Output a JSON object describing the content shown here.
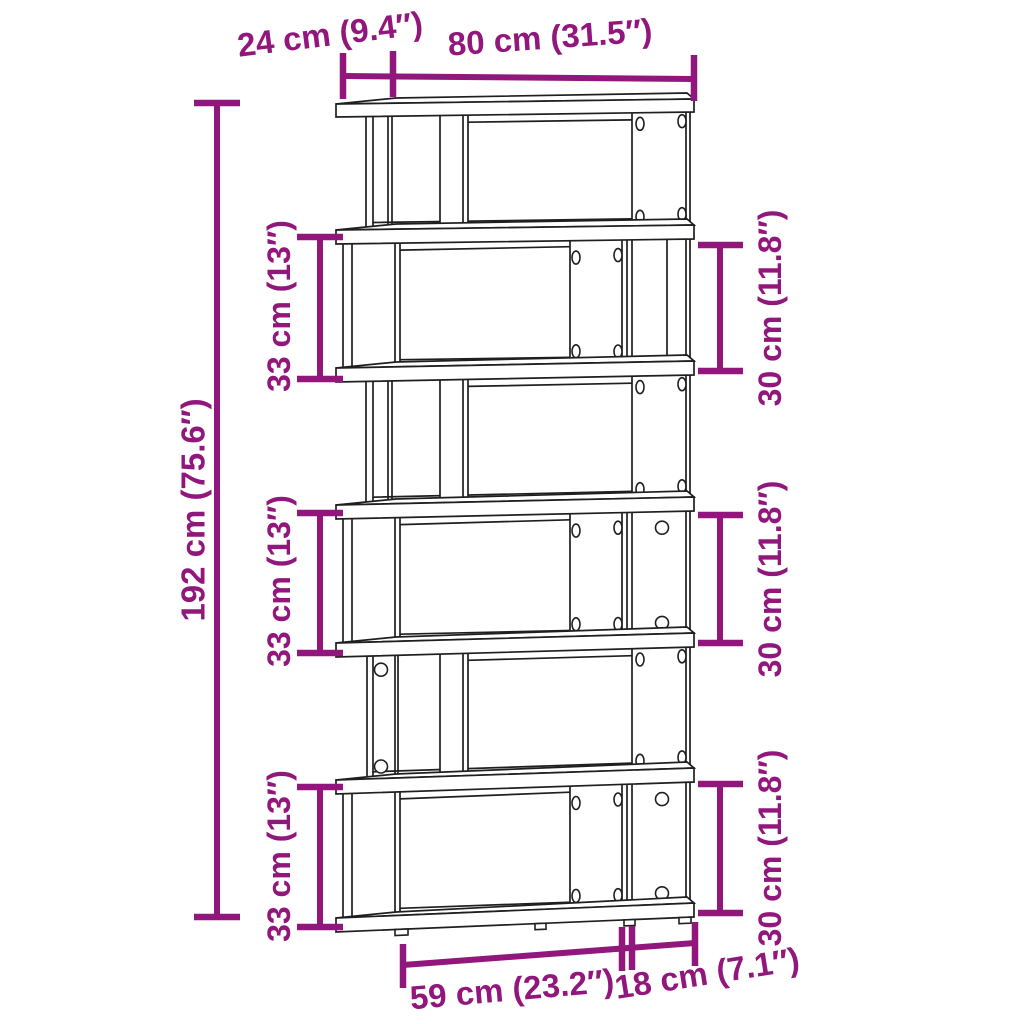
{
  "diagram": {
    "type": "product-dimension-drawing",
    "product": "6-tier zigzag bookcase / room divider",
    "style": {
      "accent": "#92177C",
      "line": "#1f1f1f",
      "bg": "#ffffff"
    },
    "labels": {
      "depth": "24 cm (9.4″)",
      "width": "80 cm (31.5″)",
      "height": "192 cm (75.6″)",
      "tier": "33 cm (13″)",
      "opening": "30 cm (11.8″)",
      "base_wide": "59 cm (23.2″)",
      "base_narrow": "18 cm (7.1″)"
    },
    "dimensions": {
      "depth": {
        "cm": 24,
        "inches": 9.4
      },
      "width": {
        "cm": 80,
        "inches": 31.5
      },
      "height": {
        "cm": 192,
        "inches": 75.6
      },
      "tier_pitch": {
        "cm": 33,
        "inches": 13,
        "occurrences": 3
      },
      "opening_height": {
        "cm": 30,
        "inches": 11.8,
        "occurrences": 3
      },
      "base_wide_section": {
        "cm": 59,
        "inches": 23.2
      },
      "base_narrow_section": {
        "cm": 18,
        "inches": 7.1
      }
    },
    "structure": {
      "tiers": 6,
      "shelf_boards": 7,
      "screw_holes_visible": true
    }
  }
}
